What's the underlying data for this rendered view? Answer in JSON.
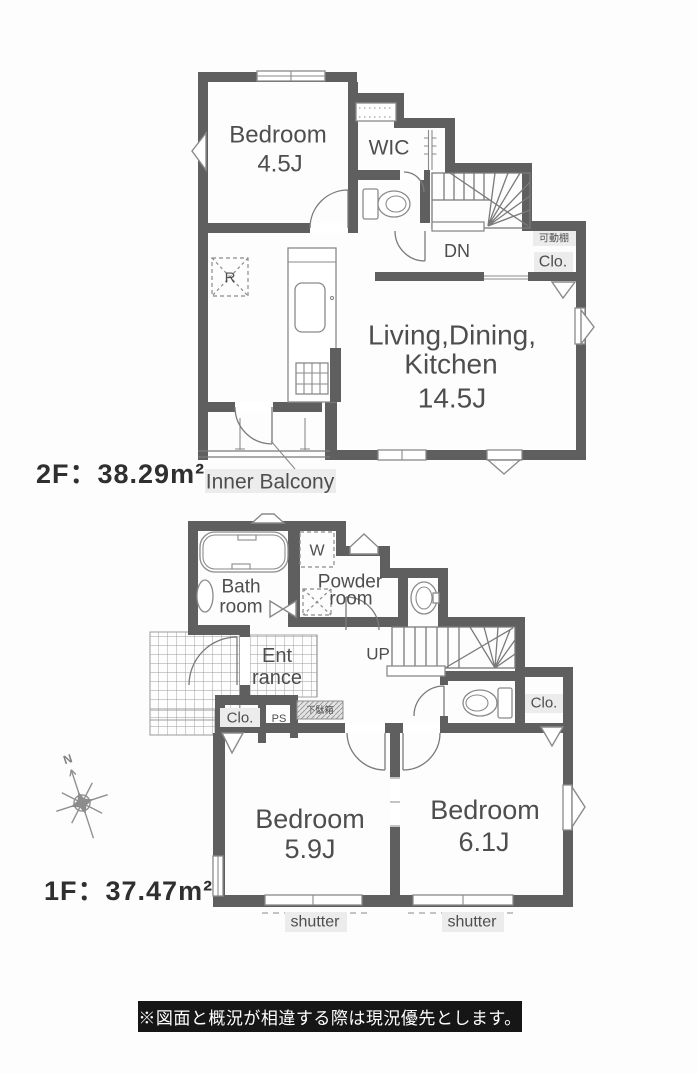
{
  "floor2": {
    "area_label": "2F：38.29m²",
    "bedroom": {
      "name": "Bedroom",
      "size": "4.5J"
    },
    "wic_label": "WIC",
    "stairs_label": "DN",
    "shelf_label": "可動棚",
    "closet_label": "Clo.",
    "ldk": {
      "name_line1": "Living,Dining,",
      "name_line2": "Kitchen",
      "size": "14.5J"
    },
    "fridge_label": "R",
    "balcony_label": "Inner Balcony"
  },
  "floor1": {
    "area_label": "1F：37.47m²",
    "bath": {
      "line1": "Bath",
      "line2": "room"
    },
    "washer_label": "W",
    "powder": {
      "line1": "Powder",
      "line2": "room"
    },
    "entrance": {
      "line1": "Ent",
      "line2": "rance"
    },
    "stairs_label": "UP",
    "closet_left_label": "Clo.",
    "ps_label": "PS",
    "shoe_cabinet_label": "下駄箱",
    "closet_right_label": "Clo.",
    "bedroom_left": {
      "name": "Bedroom",
      "size": "5.9J"
    },
    "bedroom_right": {
      "name": "Bedroom",
      "size": "6.1J"
    },
    "shutter_left_label": "shutter",
    "shutter_right_label": "shutter"
  },
  "compass": {
    "north_label": "N"
  },
  "footer": {
    "note": "※図面と概況が相違する際は現況優先とします。"
  }
}
